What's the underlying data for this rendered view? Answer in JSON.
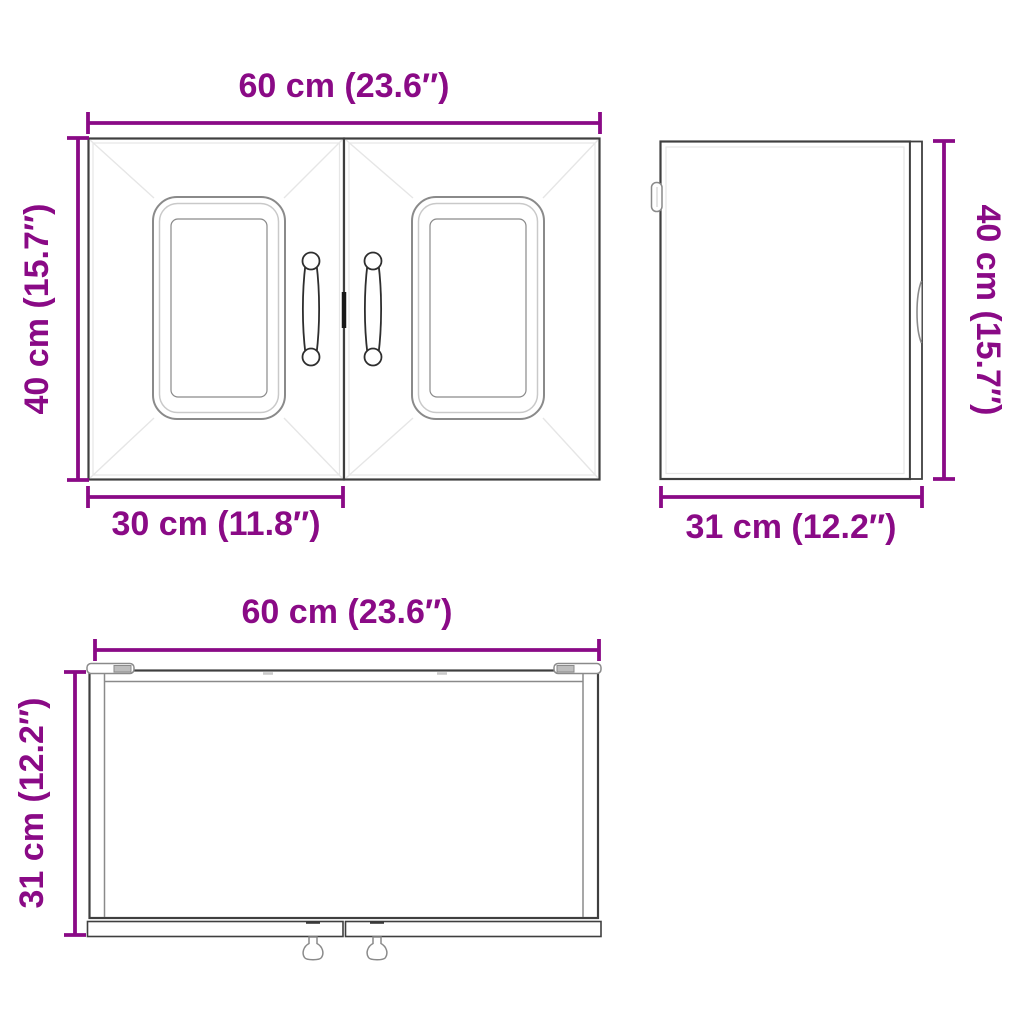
{
  "title": "Wall cabinet dimension diagram",
  "colors": {
    "dimension": "#8a0a86",
    "outline_dark": "#3f3f3f",
    "outline_mid": "#8a8a8a",
    "outline_light": "#c9c9c9",
    "outline_faint": "#e6e6e6",
    "handle_dark": "#2e2e2e",
    "background": "#ffffff"
  },
  "views": {
    "front": {
      "width_label": "60 cm (23.6″)",
      "height_label": "40 cm (15.7″)",
      "door_width_label": "30 cm (11.8″)"
    },
    "side": {
      "height_label": "40 cm (15.7″)",
      "depth_label": "31 cm (12.2″)"
    },
    "top": {
      "width_label": "60 cm (23.6″)",
      "depth_label": "31 cm (12.2″)"
    }
  }
}
